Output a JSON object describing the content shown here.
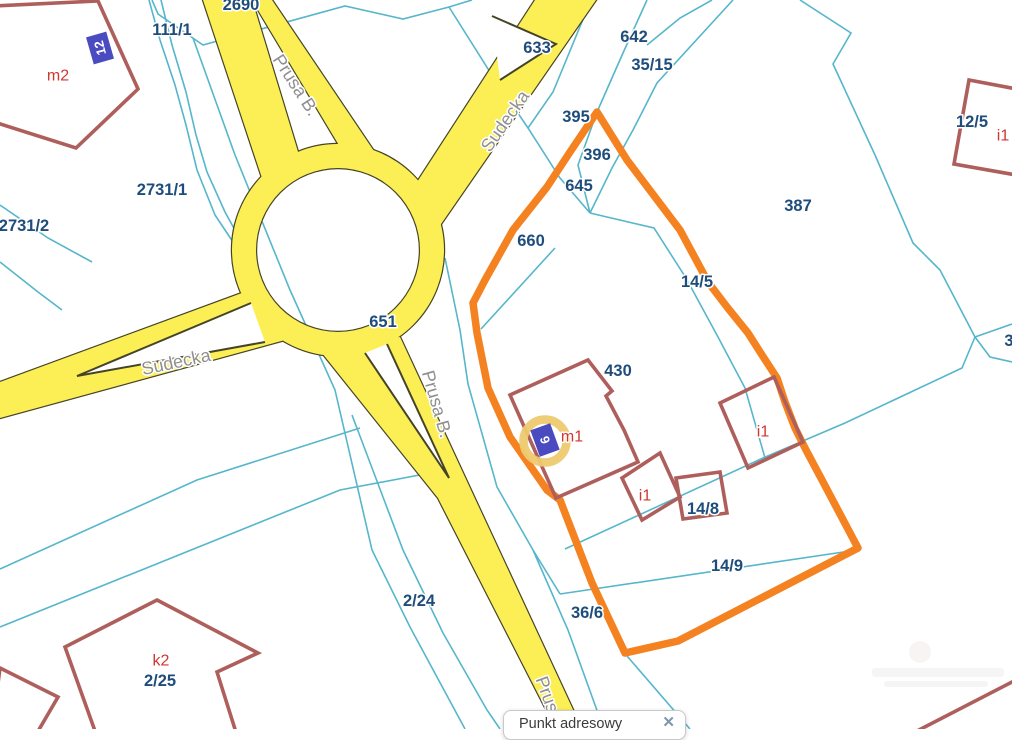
{
  "map": {
    "street_labels": [
      {
        "text": "Prusa B.",
        "x": 296,
        "y": 85,
        "rot": 57
      },
      {
        "text": "Sudecka",
        "x": 505,
        "y": 121,
        "rot": -55
      },
      {
        "text": "Sudecka",
        "x": 176,
        "y": 362,
        "rot": -12
      },
      {
        "text": "Prusa B.",
        "x": 437,
        "y": 404,
        "rot": 74
      },
      {
        "text": "Prusa",
        "x": 549,
        "y": 699,
        "rot": 70
      }
    ],
    "parcel_labels": [
      {
        "text": "2690",
        "x": 241,
        "y": 5
      },
      {
        "text": "111/1",
        "x": 172,
        "y": 30
      },
      {
        "text": "633",
        "x": 537,
        "y": 48
      },
      {
        "text": "642",
        "x": 634,
        "y": 37
      },
      {
        "text": "35/15",
        "x": 652,
        "y": 65
      },
      {
        "text": "395",
        "x": 576,
        "y": 117
      },
      {
        "text": "396",
        "x": 597,
        "y": 155
      },
      {
        "text": "645",
        "x": 579,
        "y": 186
      },
      {
        "text": "660",
        "x": 531,
        "y": 241
      },
      {
        "text": "387",
        "x": 798,
        "y": 206
      },
      {
        "text": "12/5",
        "x": 972,
        "y": 122
      },
      {
        "text": "2731/1",
        "x": 162,
        "y": 190
      },
      {
        "text": "2731/2",
        "x": 24,
        "y": 226
      },
      {
        "text": "651",
        "x": 383,
        "y": 322
      },
      {
        "text": "14/5",
        "x": 697,
        "y": 282
      },
      {
        "text": "430",
        "x": 618,
        "y": 371
      },
      {
        "text": "14/8",
        "x": 703,
        "y": 509
      },
      {
        "text": "14/9",
        "x": 727,
        "y": 566
      },
      {
        "text": "36/6",
        "x": 587,
        "y": 613
      },
      {
        "text": "2/24",
        "x": 419,
        "y": 601
      },
      {
        "text": "2/25",
        "x": 160,
        "y": 681
      },
      {
        "text": "3",
        "x": 1009,
        "y": 341
      }
    ],
    "building_labels": [
      {
        "text": "m2",
        "x": 58,
        "y": 76
      },
      {
        "text": "i1",
        "x": 1003,
        "y": 136
      },
      {
        "text": "m1",
        "x": 572,
        "y": 437
      },
      {
        "text": "i1",
        "x": 763,
        "y": 432
      },
      {
        "text": "i1",
        "x": 645,
        "y": 496
      },
      {
        "text": "k2",
        "x": 161,
        "y": 661
      }
    ],
    "address_markers": [
      {
        "number": "12",
        "x": 100,
        "y": 48,
        "rot": -16,
        "text_rot": -104,
        "highlighted": false
      },
      {
        "number": "6",
        "x": 545,
        "y": 440,
        "rot": -20,
        "text_rot": -108,
        "highlighted": true
      }
    ]
  },
  "popup": {
    "title": "Punkt adresowy",
    "close_symbol": "✕"
  },
  "colors": {
    "road_fill": "#FCEF55",
    "road_outline": "#454427",
    "selection_orange": "#F58220",
    "boundary_cyan": "#56B6CB",
    "building_stroke": "#AE5F5C",
    "parcel_text": "#1E4D7B",
    "building_text": "#CE3732",
    "street_text": "#8F8F8F",
    "marker_fill": "#4A4BC1",
    "highlight_ring": "#EEC96F"
  }
}
